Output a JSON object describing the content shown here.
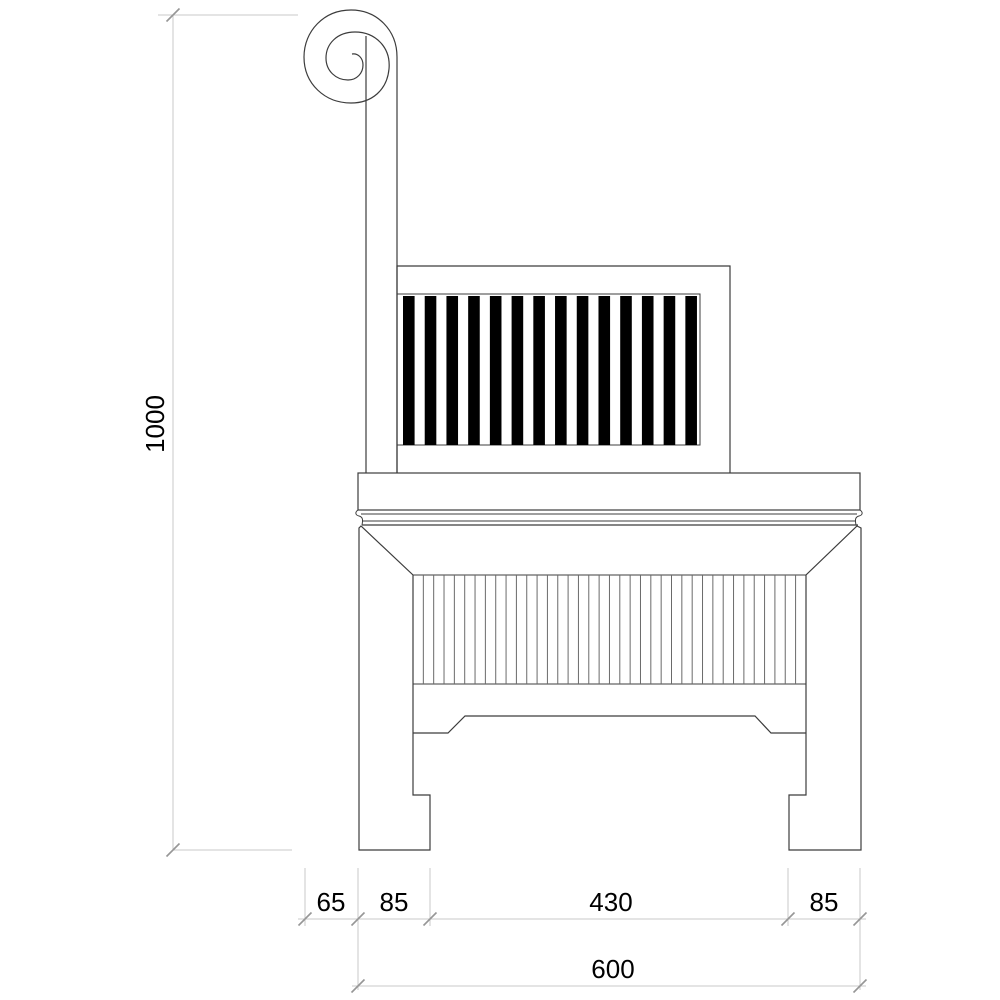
{
  "drawing_title": "scroll-arm bench side elevation",
  "dimensions": {
    "height_total": "1000",
    "width_segments": [
      "65",
      "85",
      "430",
      "85"
    ],
    "width_total": "600"
  },
  "drawing": {
    "back_panel_slats": {
      "count": 14,
      "x_start": 403,
      "period": 21.72,
      "bar_width": 11.6,
      "y": 296,
      "height": 149
    },
    "apron_reeds": {
      "count": 37,
      "x_start": 413,
      "period": 10.34,
      "y_top": 575,
      "y_bottom": 684
    },
    "colors": {
      "line": "#3c3c3c",
      "slat_fill": "#000000",
      "dimension_line": "#c8c8c8",
      "tick": "#969696",
      "text": "#000000",
      "background": "#ffffff"
    }
  }
}
